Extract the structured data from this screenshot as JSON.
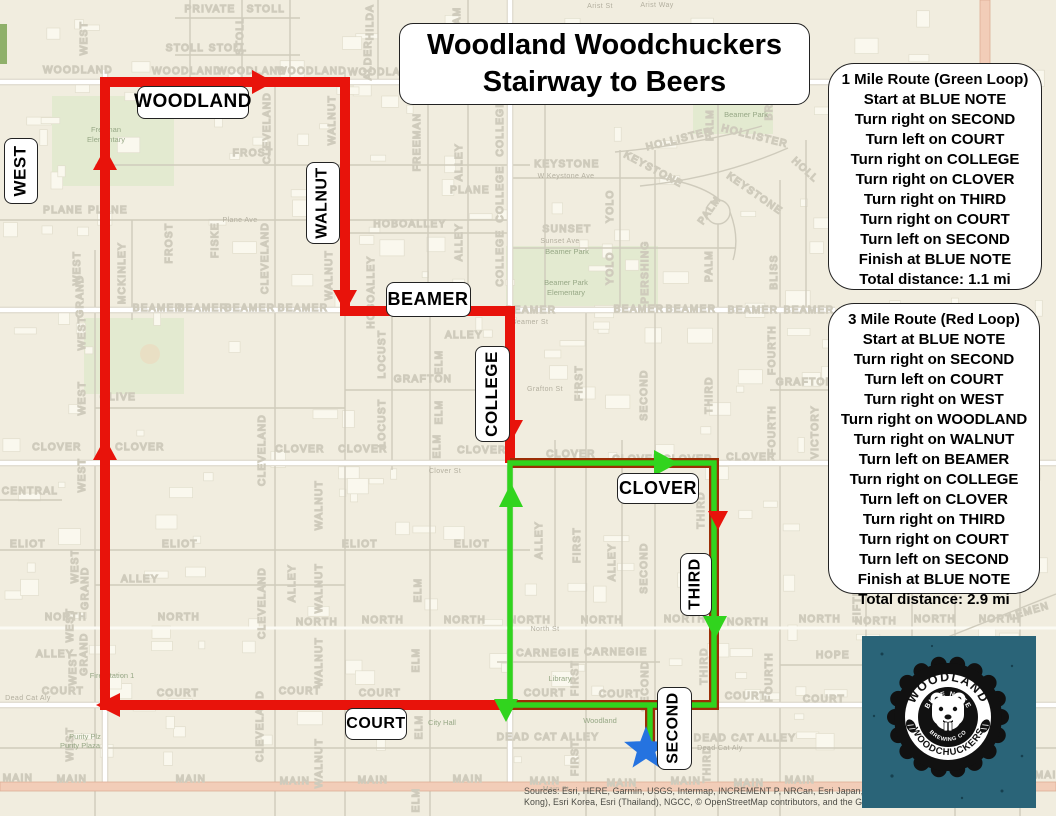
{
  "title": {
    "line1": "Woodland Woodchuckers",
    "line2": "Stairway to Beers"
  },
  "panels": {
    "green": {
      "title": "1 Mile Route  (Green Loop)",
      "steps": [
        "Start at BLUE NOTE",
        "Turn right on SECOND",
        "Turn left on COURT",
        "Turn right on COLLEGE",
        "Turn right on CLOVER",
        "Turn right on THIRD",
        "Turn right on COURT",
        "Turn left on SECOND",
        "Finish at BLUE NOTE"
      ],
      "total": "Total distance: 1.1 mi"
    },
    "red": {
      "title": "3 Mile Route (Red Loop)",
      "steps": [
        "Start at BLUE NOTE",
        "Turn right on SECOND",
        "Turn left on COURT",
        "Turn right on WEST",
        "Turn right on WOODLAND",
        "Turn right on WALNUT",
        "Turn left on BEAMER",
        "Turn right on COLLEGE",
        "Turn left on CLOVER",
        "Turn right on THIRD",
        "Turn right on COURT",
        "Turn left on SECOND",
        "Finish at BLUE NOTE"
      ],
      "total": "Total distance: 2.9 mi"
    }
  },
  "boxed_labels": [
    {
      "t": "WOODLAND",
      "x": 192,
      "y": 101,
      "w": 110,
      "h": 31,
      "fs": 19,
      "vertical": false
    },
    {
      "t": "WEST",
      "x": 20,
      "y": 170,
      "w": 32,
      "h": 64,
      "fs": 17,
      "vertical": true
    },
    {
      "t": "WALNUT",
      "x": 322,
      "y": 202,
      "w": 32,
      "h": 80,
      "fs": 16,
      "vertical": true
    },
    {
      "t": "BEAMER",
      "x": 427,
      "y": 298,
      "w": 83,
      "h": 33,
      "fs": 18,
      "vertical": false
    },
    {
      "t": "COLLEGE",
      "x": 491,
      "y": 393,
      "w": 33,
      "h": 94,
      "fs": 17,
      "vertical": true
    },
    {
      "t": "CLOVER",
      "x": 657,
      "y": 487,
      "w": 80,
      "h": 29,
      "fs": 18,
      "vertical": false
    },
    {
      "t": "THIRD",
      "x": 695,
      "y": 583,
      "w": 30,
      "h": 61,
      "fs": 16,
      "vertical": true
    },
    {
      "t": "SECOND",
      "x": 673,
      "y": 727,
      "w": 33,
      "h": 81,
      "fs": 16,
      "vertical": true
    },
    {
      "t": "COURT",
      "x": 375,
      "y": 723,
      "w": 60,
      "h": 30,
      "fs": 16,
      "vertical": false
    }
  ],
  "street_labels": [
    {
      "t": "PRIVATE",
      "x": 210,
      "y": 12
    },
    {
      "t": "STOLL",
      "x": 266,
      "y": 12
    },
    {
      "t": "STOLL",
      "x": 185,
      "y": 51
    },
    {
      "t": "STOLL",
      "x": 228,
      "y": 51
    },
    {
      "t": "STOLL",
      "x": 243,
      "y": 36,
      "r": -90
    },
    {
      "t": "WILLIAM",
      "x": 460,
      "y": 32,
      "r": -90
    },
    {
      "t": "HILDA",
      "x": 373,
      "y": 22,
      "r": -90
    },
    {
      "t": "ALDER",
      "x": 371,
      "y": 60,
      "r": -90
    },
    {
      "t": "WOODLAND",
      "x": 78,
      "y": 73
    },
    {
      "t": "WOODLAND",
      "x": 187,
      "y": 74
    },
    {
      "t": "WOODLAND",
      "x": 252,
      "y": 74
    },
    {
      "t": "WOODLAND",
      "x": 312,
      "y": 74
    },
    {
      "t": "WOODLAND",
      "x": 383,
      "y": 75
    },
    {
      "t": "WOODLAND",
      "x": 455,
      "y": 75
    },
    {
      "t": "EAST",
      "x": 985,
      "y": 112,
      "r": -90
    },
    {
      "t": "FREEMAN",
      "x": 420,
      "y": 142,
      "r": -90
    },
    {
      "t": "KEYSTONE",
      "x": 567,
      "y": 167
    },
    {
      "t": "KEYSTONE",
      "x": 652,
      "y": 172,
      "r": 28
    },
    {
      "t": "KEYSTONE",
      "x": 753,
      "y": 196,
      "r": 35
    },
    {
      "t": "HOLLISTER",
      "x": 680,
      "y": 142,
      "r": -14
    },
    {
      "t": "HOLLISTER",
      "x": 754,
      "y": 139,
      "r": 14
    },
    {
      "t": "HOLL",
      "x": 803,
      "y": 172,
      "r": 42
    },
    {
      "t": "PALM",
      "x": 713,
      "y": 125,
      "r": -90
    },
    {
      "t": "PALM",
      "x": 712,
      "y": 212,
      "r": -55
    },
    {
      "t": "PALM",
      "x": 712,
      "y": 266,
      "r": -90
    },
    {
      "t": "BR",
      "x": 772,
      "y": 112,
      "r": -90
    },
    {
      "t": "YOLO",
      "x": 613,
      "y": 206,
      "r": -90
    },
    {
      "t": "YOLO",
      "x": 613,
      "y": 268,
      "r": -90
    },
    {
      "t": "PERSHING",
      "x": 648,
      "y": 272,
      "r": -90
    },
    {
      "t": "SUNSET",
      "x": 567,
      "y": 232
    },
    {
      "t": "FROST",
      "x": 253,
      "y": 156
    },
    {
      "t": "CLEVELAND",
      "x": 270,
      "y": 128,
      "r": -90
    },
    {
      "t": "WALNUT",
      "x": 335,
      "y": 120,
      "r": -90
    },
    {
      "t": "PLANE",
      "x": 63,
      "y": 213
    },
    {
      "t": "PLANE",
      "x": 108,
      "y": 213
    },
    {
      "t": "PLANE",
      "x": 470,
      "y": 193
    },
    {
      "t": "HOBOALLEY",
      "x": 410,
      "y": 227
    },
    {
      "t": "HOBOALLEY",
      "x": 374,
      "y": 292,
      "r": -90
    },
    {
      "t": "ALLEY",
      "x": 462,
      "y": 162,
      "r": -90
    },
    {
      "t": "ALLEY",
      "x": 462,
      "y": 242,
      "r": -90
    },
    {
      "t": "COLLEGE",
      "x": 503,
      "y": 128,
      "r": -90
    },
    {
      "t": "COLLEGE",
      "x": 503,
      "y": 194,
      "r": -90
    },
    {
      "t": "COLLEGE",
      "x": 503,
      "y": 258,
      "r": -90
    },
    {
      "t": "FROST",
      "x": 172,
      "y": 243,
      "r": -90
    },
    {
      "t": "FISKE",
      "x": 218,
      "y": 240,
      "r": -90
    },
    {
      "t": "CLEVELAND",
      "x": 268,
      "y": 258,
      "r": -90
    },
    {
      "t": "MCKINLEY",
      "x": 125,
      "y": 273,
      "r": -90
    },
    {
      "t": "GRAND",
      "x": 83,
      "y": 296,
      "r": -90
    },
    {
      "t": "WEST",
      "x": 87,
      "y": 38,
      "r": -90
    },
    {
      "t": "WEST",
      "x": 80,
      "y": 268,
      "r": -90
    },
    {
      "t": "WEST",
      "x": 85,
      "y": 333,
      "r": -90
    },
    {
      "t": "WEST",
      "x": 85,
      "y": 398,
      "r": -90
    },
    {
      "t": "WEST",
      "x": 85,
      "y": 475,
      "r": -90
    },
    {
      "t": "WEST",
      "x": 78,
      "y": 566,
      "r": -90
    },
    {
      "t": "WEST",
      "x": 73,
      "y": 625,
      "r": -90
    },
    {
      "t": "WEST",
      "x": 76,
      "y": 668,
      "r": -90
    },
    {
      "t": "WEST",
      "x": 73,
      "y": 744,
      "r": -90
    },
    {
      "t": "BEAMER",
      "x": 158,
      "y": 311
    },
    {
      "t": "BEAMER",
      "x": 203,
      "y": 311
    },
    {
      "t": "BEAMER",
      "x": 250,
      "y": 311
    },
    {
      "t": "BEAMER",
      "x": 303,
      "y": 311
    },
    {
      "t": "BEAMER",
      "x": 531,
      "y": 313
    },
    {
      "t": "BEAMER",
      "x": 639,
      "y": 312
    },
    {
      "t": "BEAMER",
      "x": 691,
      "y": 312
    },
    {
      "t": "BEAMER",
      "x": 753,
      "y": 313
    },
    {
      "t": "BEAMER",
      "x": 809,
      "y": 313
    },
    {
      "t": "ALLEY",
      "x": 464,
      "y": 338
    },
    {
      "t": "GRAFTON",
      "x": 423,
      "y": 382
    },
    {
      "t": "GRAFTON",
      "x": 805,
      "y": 385
    },
    {
      "t": "LOCUST",
      "x": 385,
      "y": 354,
      "r": -90
    },
    {
      "t": "LOCUST",
      "x": 385,
      "y": 423,
      "r": -90
    },
    {
      "t": "ELM",
      "x": 442,
      "y": 362,
      "r": -90
    },
    {
      "t": "ELM",
      "x": 442,
      "y": 412,
      "r": -90
    },
    {
      "t": "ELM",
      "x": 440,
      "y": 446,
      "r": -90
    },
    {
      "t": "FIRST",
      "x": 582,
      "y": 383,
      "r": -90
    },
    {
      "t": "SECOND",
      "x": 647,
      "y": 395,
      "r": -90
    },
    {
      "t": "THIRD",
      "x": 712,
      "y": 395,
      "r": -90
    },
    {
      "t": "FOURTH",
      "x": 775,
      "y": 350,
      "r": -90
    },
    {
      "t": "FOURTH",
      "x": 775,
      "y": 430,
      "r": -90
    },
    {
      "t": "VICTORY",
      "x": 818,
      "y": 432,
      "r": -90
    },
    {
      "t": "BLISS",
      "x": 777,
      "y": 272,
      "r": -90
    },
    {
      "t": "OLIVE",
      "x": 118,
      "y": 400
    },
    {
      "t": "CLOVER",
      "x": 57,
      "y": 450
    },
    {
      "t": "CLOVER",
      "x": 140,
      "y": 450
    },
    {
      "t": "CLOVER",
      "x": 300,
      "y": 452
    },
    {
      "t": "CLOVER",
      "x": 363,
      "y": 452
    },
    {
      "t": "CLOVER",
      "x": 482,
      "y": 453
    },
    {
      "t": "CLOVER",
      "x": 571,
      "y": 457
    },
    {
      "t": "CLOVER",
      "x": 637,
      "y": 462
    },
    {
      "t": "CLOVER",
      "x": 688,
      "y": 462
    },
    {
      "t": "CLOVER",
      "x": 751,
      "y": 460
    },
    {
      "t": "CENTRAL",
      "x": 30,
      "y": 494
    },
    {
      "t": "WALNUT",
      "x": 332,
      "y": 275,
      "r": -90
    },
    {
      "t": "WALNUT",
      "x": 322,
      "y": 505,
      "r": -90
    },
    {
      "t": "WALNUT",
      "x": 322,
      "y": 588,
      "r": -90
    },
    {
      "t": "WALNUT",
      "x": 322,
      "y": 662,
      "r": -90
    },
    {
      "t": "WALNUT",
      "x": 322,
      "y": 763,
      "r": -90
    },
    {
      "t": "CLEVELAND",
      "x": 265,
      "y": 450,
      "r": -90
    },
    {
      "t": "CLEVELAND",
      "x": 265,
      "y": 603,
      "r": -90
    },
    {
      "t": "CLEVELAND",
      "x": 263,
      "y": 726,
      "r": -90
    },
    {
      "t": "GRAND",
      "x": 88,
      "y": 588,
      "r": -90
    },
    {
      "t": "GRAND",
      "x": 87,
      "y": 654,
      "r": -90
    },
    {
      "t": "ELIOT",
      "x": 28,
      "y": 547
    },
    {
      "t": "ELIOT",
      "x": 180,
      "y": 547
    },
    {
      "t": "ELIOT",
      "x": 360,
      "y": 547
    },
    {
      "t": "ELIOT",
      "x": 472,
      "y": 547
    },
    {
      "t": "ALLEY",
      "x": 140,
      "y": 582
    },
    {
      "t": "ALLEY",
      "x": 295,
      "y": 583,
      "r": -90
    },
    {
      "t": "ALLEY",
      "x": 55,
      "y": 657
    },
    {
      "t": "ALLEY",
      "x": 542,
      "y": 540,
      "r": -90
    },
    {
      "t": "ALLEY",
      "x": 615,
      "y": 562,
      "r": -90
    },
    {
      "t": "FIRST",
      "x": 580,
      "y": 545,
      "r": -90
    },
    {
      "t": "FIRST",
      "x": 578,
      "y": 678,
      "r": -90
    },
    {
      "t": "FIRST",
      "x": 578,
      "y": 758,
      "r": -90
    },
    {
      "t": "SECOND",
      "x": 647,
      "y": 568,
      "r": -90
    },
    {
      "t": "SECOND",
      "x": 648,
      "y": 686,
      "r": -90
    },
    {
      "t": "THIRD",
      "x": 704,
      "y": 510,
      "r": -90
    },
    {
      "t": "THIRD",
      "x": 707,
      "y": 666,
      "r": -90
    },
    {
      "t": "THIRD",
      "x": 710,
      "y": 764,
      "r": -90
    },
    {
      "t": "ELM",
      "x": 421,
      "y": 590,
      "r": -90
    },
    {
      "t": "ELM",
      "x": 419,
      "y": 660,
      "r": -90
    },
    {
      "t": "ELM",
      "x": 422,
      "y": 727,
      "r": -90
    },
    {
      "t": "ELM",
      "x": 419,
      "y": 800,
      "r": -90
    },
    {
      "t": "NORTH",
      "x": 66,
      "y": 620
    },
    {
      "t": "NORTH",
      "x": 179,
      "y": 620
    },
    {
      "t": "NORTH",
      "x": 317,
      "y": 625
    },
    {
      "t": "NORTH",
      "x": 383,
      "y": 623
    },
    {
      "t": "NORTH",
      "x": 465,
      "y": 623
    },
    {
      "t": "NORTH",
      "x": 530,
      "y": 623
    },
    {
      "t": "NORTH",
      "x": 602,
      "y": 623
    },
    {
      "t": "NORTH",
      "x": 685,
      "y": 622
    },
    {
      "t": "NORTH",
      "x": 748,
      "y": 625
    },
    {
      "t": "NORTH",
      "x": 820,
      "y": 622
    },
    {
      "t": "NORTH",
      "x": 876,
      "y": 624
    },
    {
      "t": "NORTH",
      "x": 935,
      "y": 622
    },
    {
      "t": "NORTH",
      "x": 1000,
      "y": 622
    },
    {
      "t": "COURT",
      "x": 63,
      "y": 694
    },
    {
      "t": "COURT",
      "x": 178,
      "y": 696
    },
    {
      "t": "COURT",
      "x": 300,
      "y": 694
    },
    {
      "t": "COURT",
      "x": 380,
      "y": 696
    },
    {
      "t": "COURT",
      "x": 545,
      "y": 696
    },
    {
      "t": "COURT",
      "x": 620,
      "y": 697
    },
    {
      "t": "COURT",
      "x": 746,
      "y": 699
    },
    {
      "t": "COURT",
      "x": 824,
      "y": 702
    },
    {
      "t": "COURT",
      "x": 955,
      "y": 698
    },
    {
      "t": "CARNEGIE",
      "x": 548,
      "y": 656
    },
    {
      "t": "CARNEGIE",
      "x": 616,
      "y": 655
    },
    {
      "t": "HOPE",
      "x": 833,
      "y": 658
    },
    {
      "t": "LEMEN",
      "x": 1030,
      "y": 614,
      "r": -16
    },
    {
      "t": "FOURTH",
      "x": 772,
      "y": 677,
      "r": -90
    },
    {
      "t": "FIFTH",
      "x": 860,
      "y": 605,
      "r": -90
    },
    {
      "t": "DEAD CAT ALLEY",
      "x": 548,
      "y": 740
    },
    {
      "t": "DEAD CAT ALLEY",
      "x": 745,
      "y": 741
    },
    {
      "t": "MAIN",
      "x": 18,
      "y": 781
    },
    {
      "t": "MAIN",
      "x": 72,
      "y": 782
    },
    {
      "t": "MAIN",
      "x": 191,
      "y": 782
    },
    {
      "t": "MAIN",
      "x": 295,
      "y": 784
    },
    {
      "t": "MAIN",
      "x": 373,
      "y": 783
    },
    {
      "t": "MAIN",
      "x": 468,
      "y": 782
    },
    {
      "t": "MAIN",
      "x": 545,
      "y": 784
    },
    {
      "t": "MAIN",
      "x": 622,
      "y": 786
    },
    {
      "t": "MAIN",
      "x": 686,
      "y": 784
    },
    {
      "t": "MAIN",
      "x": 749,
      "y": 786
    },
    {
      "t": "MAIN",
      "x": 800,
      "y": 783
    },
    {
      "t": "MAIN",
      "x": 1050,
      "y": 778
    }
  ],
  "road_names": [
    {
      "t": "Arist St",
      "x": 600,
      "y": 8
    },
    {
      "t": "Arist Way",
      "x": 657,
      "y": 7
    },
    {
      "t": "W Keystone Ave",
      "x": 566,
      "y": 178
    },
    {
      "t": "Sunset Ave",
      "x": 560,
      "y": 243
    },
    {
      "t": "Plane Ave",
      "x": 240,
      "y": 222
    },
    {
      "t": "Beamer St",
      "x": 530,
      "y": 324
    },
    {
      "t": "Grafton St",
      "x": 545,
      "y": 391
    },
    {
      "t": "Clover St",
      "x": 445,
      "y": 473
    },
    {
      "t": "North St",
      "x": 545,
      "y": 631
    },
    {
      "t": "Dead Cat Aly",
      "x": 28,
      "y": 700
    },
    {
      "t": "Dead Cat Aly",
      "x": 720,
      "y": 750
    },
    {
      "t": "Main St",
      "x": 556,
      "y": 791
    }
  ],
  "places": [
    {
      "t": "Freeman",
      "x": 106,
      "y": 132
    },
    {
      "t": "Elementary",
      "x": 106,
      "y": 142
    },
    {
      "t": "Beamer Park",
      "x": 567,
      "y": 254
    },
    {
      "t": "Beamer Park",
      "x": 566,
      "y": 285
    },
    {
      "t": "Elementary",
      "x": 566,
      "y": 295
    },
    {
      "t": "Beamer Park",
      "x": 746,
      "y": 117
    },
    {
      "t": "Purity Plz",
      "x": 85,
      "y": 739
    },
    {
      "t": "Purity Plaza",
      "x": 80,
      "y": 748
    },
    {
      "t": "City Hall",
      "x": 442,
      "y": 725
    },
    {
      "t": "Woodland",
      "x": 600,
      "y": 723
    },
    {
      "t": "Library",
      "x": 560,
      "y": 681
    },
    {
      "t": "Fire Station 1",
      "x": 112,
      "y": 678
    }
  ],
  "star": {
    "cx": 646,
    "cy": 749,
    "r": 23
  },
  "logo": {
    "arc_top": "WOODLAND",
    "arc_bottom": "WOODCHUCKERS",
    "inner_top": "BLUE NOTE",
    "inner_bottom": "BREWING CO"
  },
  "attribution": {
    "line1": "Sources: Esri, HERE, Garmin, USGS, Intermap, INCREMENT P, NRCan, Esri Japan, METI, Esri China (Hong",
    "line2": "Kong), Esri Korea, Esri (Thailand), NGCC, © OpenStreetMap contributors, and the GIS User Community"
  },
  "colors": {
    "bg": "#F1EDDF",
    "route_red": "#E8130B",
    "route_red_dark": "#9B2E06",
    "route_green": "#31D41E",
    "star": "#2573E0",
    "logo_bg": "#2A6478",
    "park": "#E3EAD0",
    "park_text": "#97A886",
    "road_pink": "#F2CDB8"
  }
}
